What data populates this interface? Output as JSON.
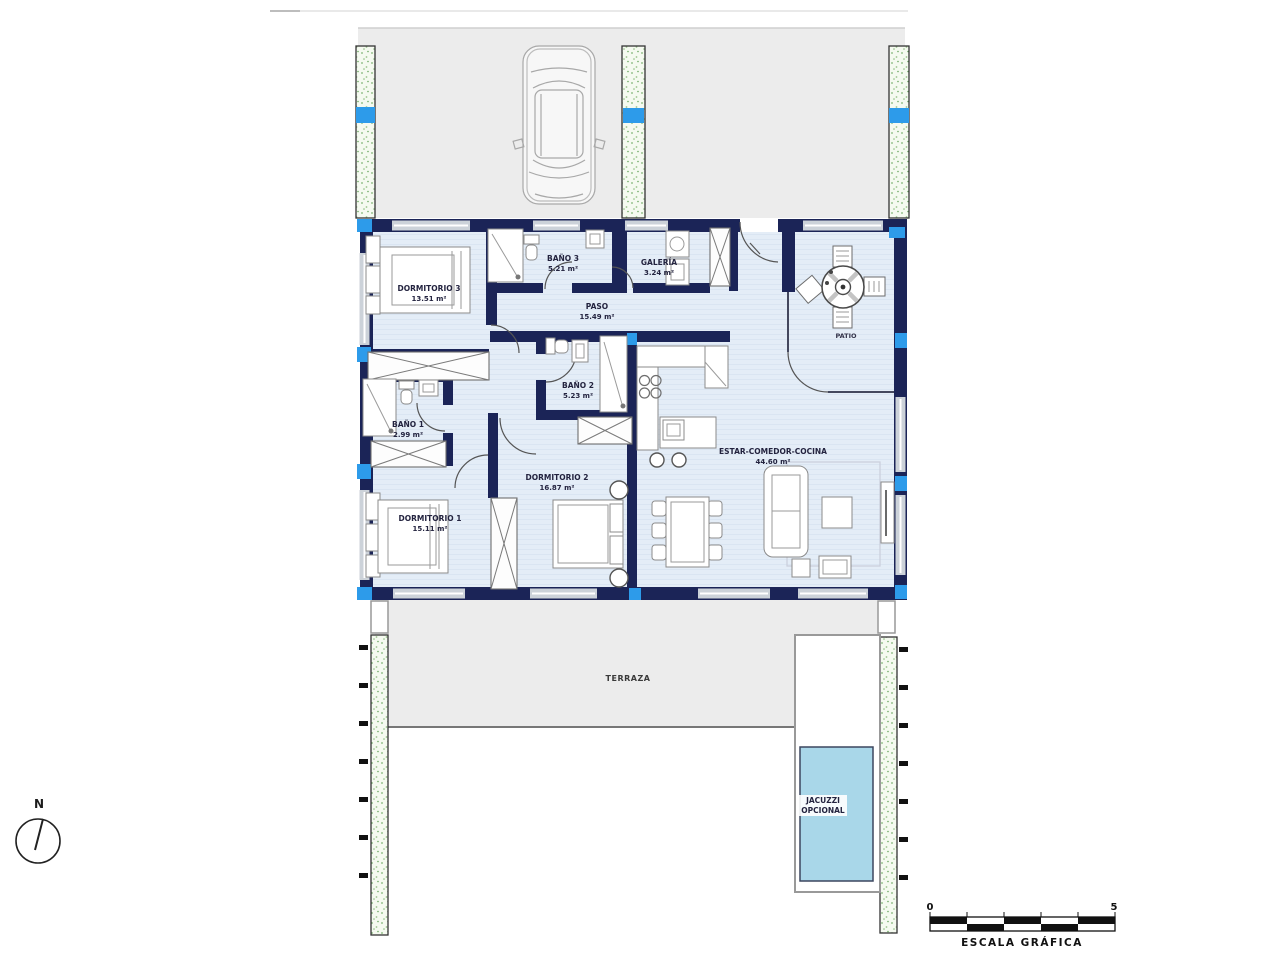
{
  "plan": {
    "rooms": [
      {
        "id": "dormitorio-3",
        "name": "DORMITORIO 3",
        "area": "13.51 m²"
      },
      {
        "id": "bano-3",
        "name": "BAÑO 3",
        "area": "5.21 m²"
      },
      {
        "id": "galeria",
        "name": "GALERÍA",
        "area": "3.24 m²"
      },
      {
        "id": "paso",
        "name": "PASO",
        "area": "15.49 m²"
      },
      {
        "id": "bano-2",
        "name": "BAÑO 2",
        "area": "5.23 m²"
      },
      {
        "id": "bano-1",
        "name": "BAÑO 1",
        "area": "2.99 m²"
      },
      {
        "id": "dormitorio-2",
        "name": "DORMITORIO 2",
        "area": "16.87 m²"
      },
      {
        "id": "dormitorio-1",
        "name": "DORMITORIO 1",
        "area": "15.11 m²"
      },
      {
        "id": "estar-comedor-cocina",
        "name": "ESTAR-COMEDOR-COCINA",
        "area": "44.60 m²"
      }
    ],
    "outdoor": {
      "patio_label": "PATIO",
      "terraza_label": "TERRAZA",
      "jacuzzi_label_line1": "JACUZZI",
      "jacuzzi_label_line2": "OPCIONAL"
    },
    "compass": {
      "north_label": "N"
    },
    "scale_bar": {
      "start_label": "0",
      "end_label": "5",
      "caption": "ESCALA GRÁFICA"
    },
    "colors": {
      "wall_navy": "#1b2457",
      "floor_blue": "#e4edf7",
      "paving_gray": "#ececec",
      "marker_blue": "#2d9bea",
      "pool_blue": "#a9d7e9",
      "hedge_green": "#7eb474"
    }
  }
}
